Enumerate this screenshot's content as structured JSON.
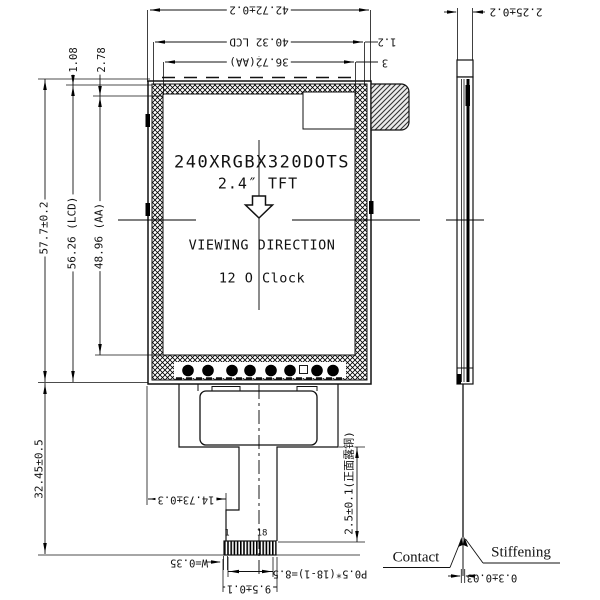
{
  "drawing": {
    "title": {
      "line1": "240XRGBX320DOTS",
      "line2": "2.4″   TFT",
      "viewing": "VIEWING DIRECTION",
      "clock": "12 O Clock"
    },
    "dims": {
      "total_width": "42.72±0.2",
      "lcd_width": "40.32 LCD",
      "aa_width": "36.72(AA)",
      "right_margin": "1.2",
      "aa_margin": "3",
      "total_height": "57.7±0.2",
      "lcd_height": "56.26 (LCD)",
      "aa_height": "48.96 (AA)",
      "top_margin": "1.08",
      "aa_top_margin": "2.78",
      "fpc_height": "32.45±0.5",
      "fpc_offset": "14.73±0.3",
      "contact_width": "W=0.35",
      "pitch": "P0.5*(18-1)=8.5",
      "fpc_end_width": "9.5±0.1",
      "exposed_copper": "2.5±0.1(正面露铜)",
      "thickness": "2.25±0.2",
      "fpc_thickness": "0.3±0.03"
    },
    "labels": {
      "pin_first": "1",
      "pin_last": "18",
      "contact": "Contact",
      "stiffening": "Stiffening"
    }
  }
}
